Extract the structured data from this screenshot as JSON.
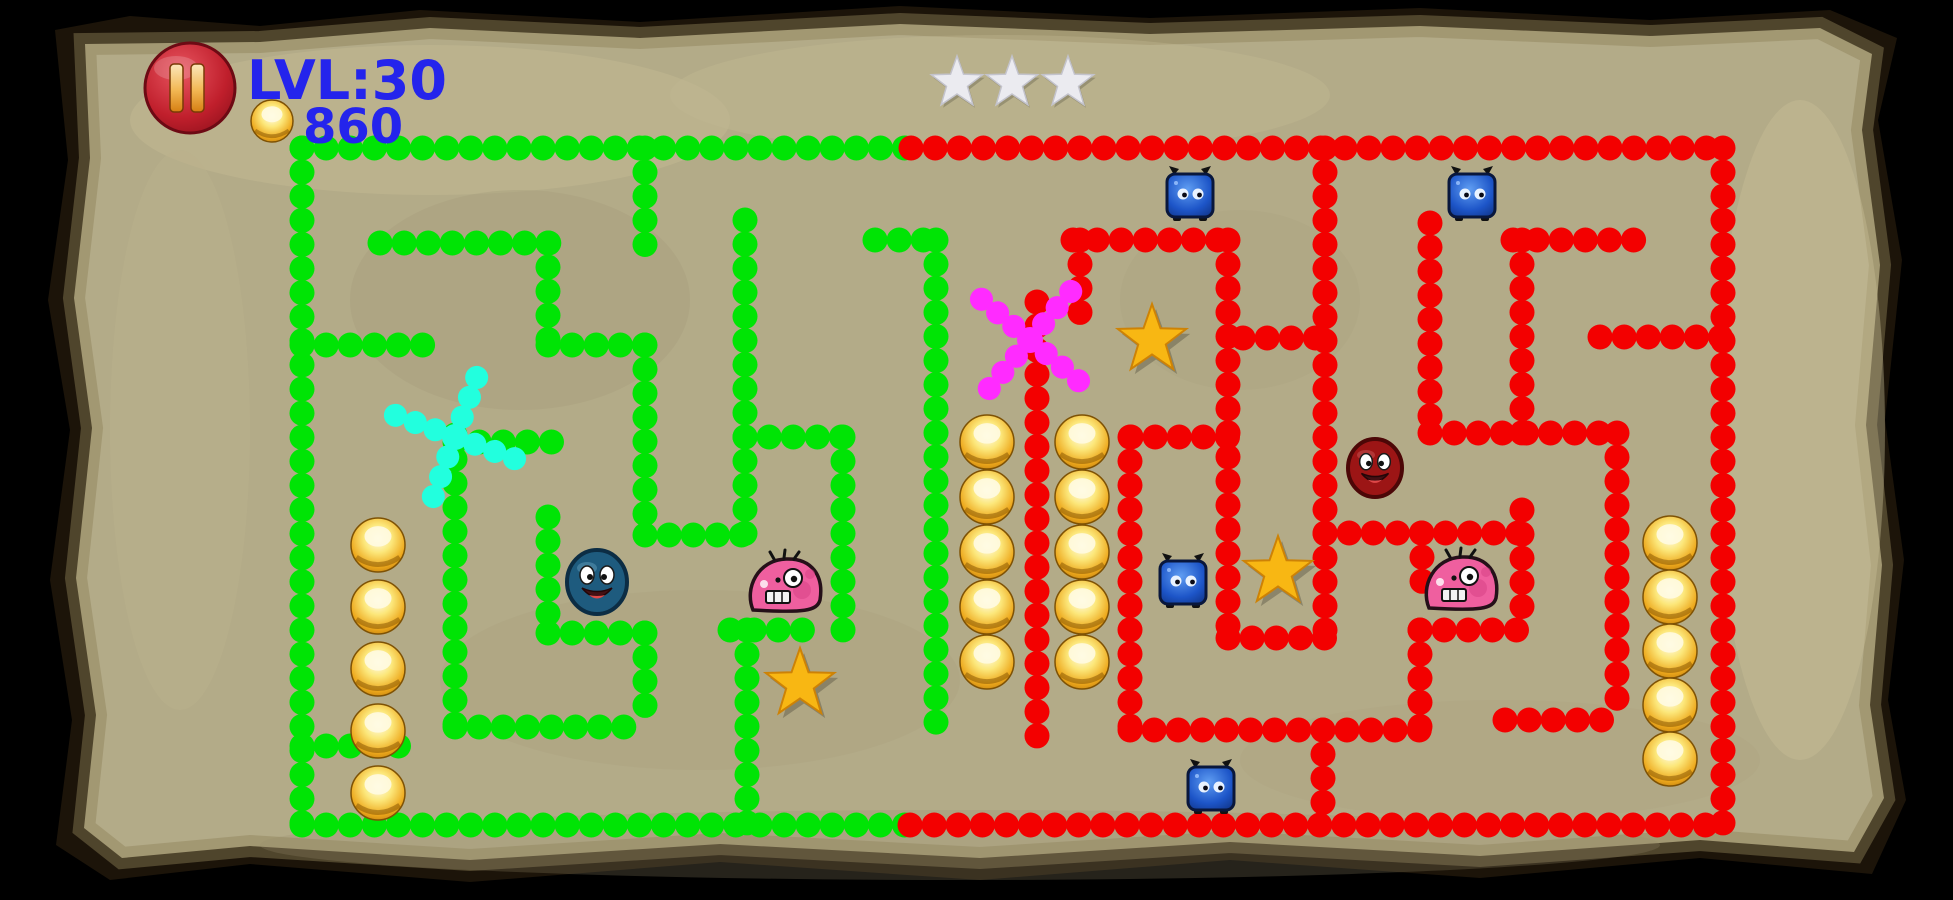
{
  "hud": {
    "level_label": "LVL:30",
    "coin_count": "860",
    "text_color": "#2424ec",
    "rating_star_count": 3,
    "rating_star_color": "#ebebf0",
    "rating_stars": [
      {
        "x": 957,
        "y": 83
      },
      {
        "x": 1012,
        "y": 83
      },
      {
        "x": 1068,
        "y": 83
      }
    ],
    "pause_button": {
      "x": 190,
      "y": 88,
      "radius": 44,
      "icon": "pause-icon"
    },
    "coin_icon": {
      "x": 272,
      "y": 121,
      "radius": 21
    }
  },
  "page": {
    "background": "#000000",
    "parchment": "#b3ab88",
    "parchment_light": "#cac098",
    "parchment_dark": "#9d9474",
    "edge_color": "#1c1409"
  },
  "maze": {
    "colors": {
      "green": "#00e405",
      "red": "#f30000",
      "cyan": "#22ffde",
      "magenta": "#ff2bff"
    },
    "dot": {
      "size": 25,
      "spacing": 24
    },
    "green_walls": [
      [
        302,
        148,
        911,
        148
      ],
      [
        302,
        148,
        302,
        825
      ],
      [
        302,
        825,
        911,
        825
      ],
      [
        380,
        243,
        560,
        243
      ],
      [
        548,
        243,
        548,
        347
      ],
      [
        548,
        345,
        645,
        345
      ],
      [
        645,
        148,
        645,
        263
      ],
      [
        645,
        345,
        645,
        535
      ],
      [
        645,
        535,
        745,
        535
      ],
      [
        745,
        220,
        745,
        535
      ],
      [
        302,
        345,
        430,
        345
      ],
      [
        302,
        746,
        420,
        746
      ],
      [
        745,
        437,
        843,
        437
      ],
      [
        843,
        437,
        843,
        630
      ],
      [
        455,
        435,
        455,
        727
      ],
      [
        455,
        442,
        567,
        442
      ],
      [
        455,
        727,
        645,
        727
      ],
      [
        548,
        517,
        548,
        633
      ],
      [
        548,
        633,
        645,
        633
      ],
      [
        645,
        633,
        645,
        727
      ],
      [
        730,
        630,
        815,
        630
      ],
      [
        747,
        630,
        747,
        825
      ],
      [
        875,
        240,
        936,
        240
      ],
      [
        936,
        240,
        936,
        723
      ]
    ],
    "red_walls": [
      [
        911,
        148,
        1723,
        148
      ],
      [
        1723,
        148,
        1723,
        825
      ],
      [
        910,
        825,
        1723,
        825
      ],
      [
        1073,
        240,
        1228,
        240
      ],
      [
        1080,
        240,
        1080,
        330
      ],
      [
        1228,
        240,
        1228,
        638
      ],
      [
        1131,
        437,
        1228,
        437
      ],
      [
        1130,
        437,
        1130,
        730
      ],
      [
        1228,
        638,
        1325,
        638
      ],
      [
        1325,
        148,
        1325,
        638
      ],
      [
        1243,
        338,
        1325,
        338
      ],
      [
        1037,
        302,
        1037,
        753
      ],
      [
        1130,
        730,
        1420,
        730
      ],
      [
        1323,
        730,
        1323,
        825
      ],
      [
        1325,
        533,
        1522,
        533
      ],
      [
        1422,
        533,
        1422,
        585
      ],
      [
        1420,
        630,
        1420,
        730
      ],
      [
        1420,
        630,
        1530,
        630
      ],
      [
        1430,
        223,
        1430,
        433
      ],
      [
        1430,
        433,
        1617,
        433
      ],
      [
        1617,
        433,
        1617,
        717
      ],
      [
        1505,
        720,
        1617,
        720
      ],
      [
        1513,
        240,
        1643,
        240
      ],
      [
        1522,
        240,
        1522,
        433
      ],
      [
        1522,
        510,
        1522,
        620
      ],
      [
        1600,
        337,
        1723,
        337
      ]
    ],
    "spinners": [
      {
        "name": "cyan-spinner",
        "x": 455,
        "y": 437,
        "color": "#22ffde",
        "angles": [
          20,
          110,
          200,
          290
        ],
        "len": 80
      },
      {
        "name": "magenta-spinner",
        "x": 1030,
        "y": 340,
        "color": "#ff2bff",
        "angles": [
          40,
          130,
          220,
          310
        ],
        "len": 84
      }
    ],
    "gold_stars": [
      {
        "x": 800,
        "y": 684
      },
      {
        "x": 1152,
        "y": 340
      },
      {
        "x": 1278,
        "y": 572
      }
    ],
    "coin_columns": [
      {
        "x": 378,
        "ys": [
          545,
          607,
          669,
          731,
          793
        ]
      },
      {
        "x": 987,
        "ys": [
          442,
          497,
          552,
          607,
          662
        ]
      },
      {
        "x": 1082,
        "ys": [
          442,
          497,
          552,
          607,
          662
        ]
      },
      {
        "x": 1670,
        "ys": [
          543,
          597,
          651,
          705,
          759
        ]
      }
    ],
    "monsters": [
      {
        "type": "blue-square",
        "x": 1190,
        "y": 195
      },
      {
        "type": "blue-square",
        "x": 1472,
        "y": 195
      },
      {
        "type": "blue-square",
        "x": 1183,
        "y": 582
      },
      {
        "type": "blue-square",
        "x": 1211,
        "y": 788
      },
      {
        "type": "blue-ball",
        "x": 597,
        "y": 582
      },
      {
        "type": "red-ball",
        "x": 1375,
        "y": 468
      },
      {
        "type": "pink-blob",
        "x": 786,
        "y": 586
      },
      {
        "type": "pink-blob",
        "x": 1462,
        "y": 584
      }
    ]
  }
}
